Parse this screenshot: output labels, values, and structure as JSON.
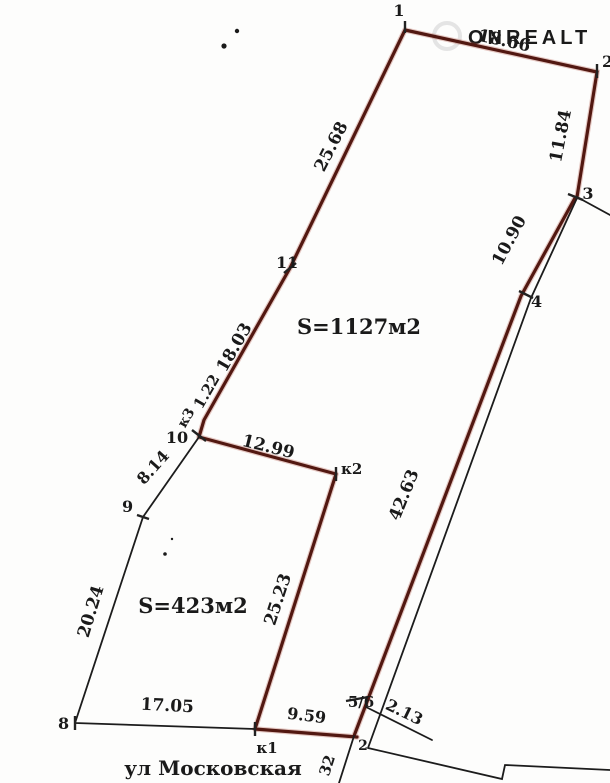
{
  "watermark": {
    "text": "ONREALT"
  },
  "areas": {
    "large": "S=1127м2",
    "small": "S=423м2"
  },
  "street": {
    "name": "ул Московская"
  },
  "points": {
    "p1": "1",
    "p2": "2",
    "p3": "3",
    "p4": "4",
    "p56": "5/6",
    "p8": "8",
    "p9": "9",
    "p10": "10",
    "p11": "11",
    "k1": "к1",
    "k2": "к2",
    "k3": "к3",
    "bottom": "2"
  },
  "measurements": {
    "seg_1_2": "18.66",
    "seg_2_3": "11.84",
    "seg_3_4": "10.90",
    "seg_4_56": "42.63",
    "seg_56_ext": "2.13",
    "seg_k1_56": "9.59",
    "seg_8_k1": "17.05",
    "seg_8_9": "20.24",
    "seg_9_10": "8.14",
    "seg_k3_10": "1.22",
    "seg_10_k2": "12.99",
    "seg_k2_k1": "25.23",
    "seg_k3_11": "18.03",
    "seg_11_1": "25.68",
    "seg_bottom_partial": "32"
  },
  "colors": {
    "boundary": "#521811",
    "boundary_glow": "#b05040",
    "thin_line": "#1c1c1c",
    "label": "#1a1a1a",
    "watermark": "#e4e4e4"
  }
}
